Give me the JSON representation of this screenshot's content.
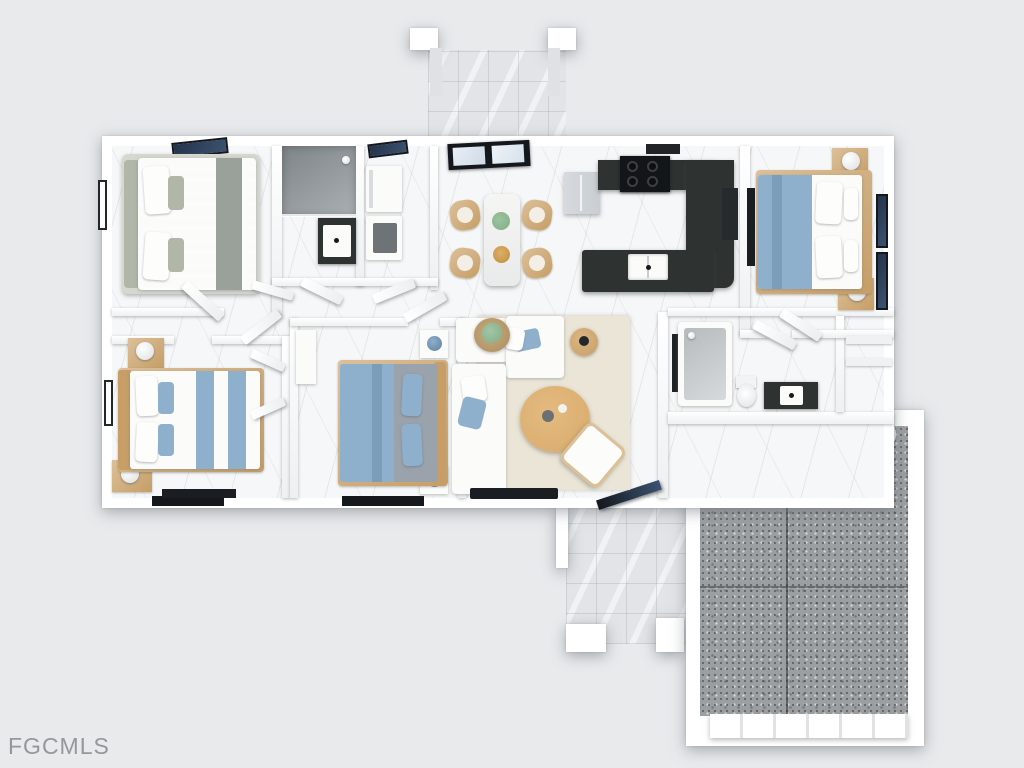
{
  "watermark": {
    "text": "FGCMLS"
  },
  "palette": {
    "background": "#e8eaec",
    "wall": "#ffffff",
    "wall_shade": "#eef0f1",
    "floor": "#f6f7f8",
    "tile": "#e2e4e7",
    "shower_dark": "#7e8487",
    "shower_light": "#aab0b3",
    "counter": "#2e3332",
    "stove": "#131619",
    "glass": "#24344a",
    "frame_dark": "#14181d",
    "wood": "#c69e66",
    "wood_light": "#dcc09a",
    "bed_blue": "#8fb0cc",
    "bed_blue_deep": "#7d9cba",
    "sage": "#b0b6a8",
    "gray_blanket": "#9aa19b",
    "slate_sheet": "#9aa2ab",
    "rug": "#eae5d7",
    "garage_floor": "#9c9fa2",
    "heater": "#5d6165",
    "steel": "#c9ced3",
    "dryer": "#6e7377",
    "tv": "#1a1d21",
    "sofa": "#fbfbfa",
    "table_wood": "#d9ab6b",
    "plant": "#7fae84",
    "bowl": "#c08a3e",
    "watermark": "#95989a"
  }
}
